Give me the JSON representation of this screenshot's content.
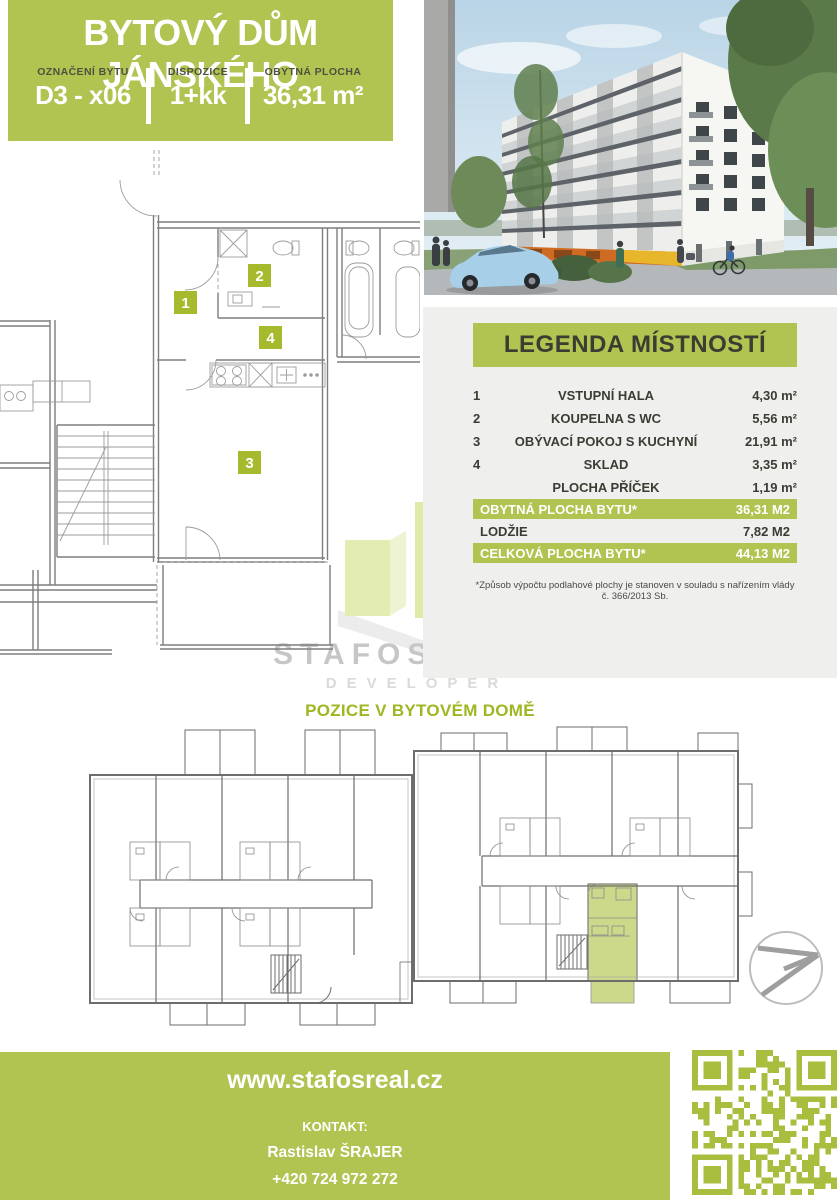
{
  "colors": {
    "accent_green": "#b1c351",
    "badge_green": "#a7ba2e",
    "heading_green": "#9fb622",
    "highlight_unit_green": "#ccd98b",
    "panel_gray": "#efefee",
    "text_dark": "#3c3c33"
  },
  "header": {
    "title": "BYTOVÝ DŮM JÁNSKÉHO",
    "fields": [
      {
        "label": "OZNAČENÍ BYTU",
        "value": "D3 - x06"
      },
      {
        "label": "DISPOZICE",
        "value": "1+kk"
      },
      {
        "label": "OBYTNÁ PLOCHA",
        "value": "36,31 m²"
      }
    ]
  },
  "legend": {
    "title": "LEGENDA MÍSTNOSTÍ",
    "rows": [
      {
        "num": "1",
        "name": "VSTUPNÍ HALA",
        "area": "4,30 m²"
      },
      {
        "num": "2",
        "name": "KOUPELNA S WC",
        "area": "5,56 m²"
      },
      {
        "num": "3",
        "name": "OBÝVACÍ POKOJ S KUCHYNÍ",
        "area": "21,91 m²"
      },
      {
        "num": "4",
        "name": "SKLAD",
        "area": "3,35 m²"
      },
      {
        "num": "",
        "name": "PLOCHA PŘÍČEK",
        "area": "1,19 m²"
      }
    ],
    "summary": [
      {
        "name": "OBYTNÁ PLOCHA BYTU*",
        "area": "36,31 M2"
      },
      {
        "name": "LODŽIE",
        "area": "7,82 M2"
      },
      {
        "name": "CELKOVÁ PLOCHA BYTU*",
        "area": "44,13 M2"
      }
    ],
    "footnote": "*Způsob výpočtu podlahové plochy je stanoven v souladu s nařízením vlády č. 366/2013 Sb."
  },
  "plan": {
    "badges": [
      "1",
      "2",
      "3",
      "4"
    ]
  },
  "logo": {
    "name": "STAFOS-REAL",
    "subtitle": "DEVELOPER"
  },
  "position_heading": "POZICE V BYTOVÉM DOMĚ",
  "footer": {
    "website": "www.stafosreal.cz",
    "contact_label": "KONTAKT:",
    "contact_name": "Rastislav ŠRAJER",
    "phone": "+420 724 972 272"
  }
}
